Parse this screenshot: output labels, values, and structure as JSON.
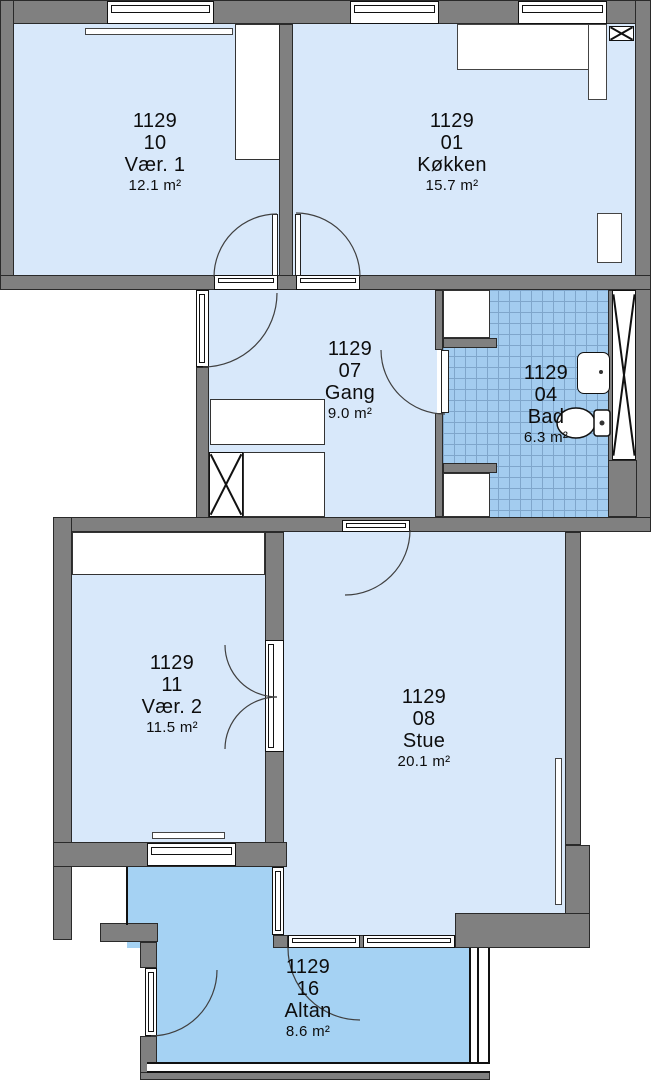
{
  "plan": {
    "rooms": [
      {
        "id": "1129",
        "number": "10",
        "name": "Vær. 1",
        "area": "12.1 m²"
      },
      {
        "id": "1129",
        "number": "01",
        "name": "Køkken",
        "area": "15.7 m²"
      },
      {
        "id": "1129",
        "number": "07",
        "name": "Gang",
        "area": "9.0 m²"
      },
      {
        "id": "1129",
        "number": "04",
        "name": "Bad",
        "area": "6.3 m²"
      },
      {
        "id": "1129",
        "number": "11",
        "name": "Vær. 2",
        "area": "11.5 m²"
      },
      {
        "id": "1129",
        "number": "08",
        "name": "Stue",
        "area": "20.1 m²"
      },
      {
        "id": "1129",
        "number": "16",
        "name": "Altan",
        "area": "8.6 m²"
      }
    ],
    "colors": {
      "wall": "#808080",
      "room": "#D8E8FA",
      "tile": "#A3CCEF",
      "tileline": "#7FA6CB",
      "balcony": "#A5D2F3",
      "line": "#1F1F1F"
    }
  }
}
